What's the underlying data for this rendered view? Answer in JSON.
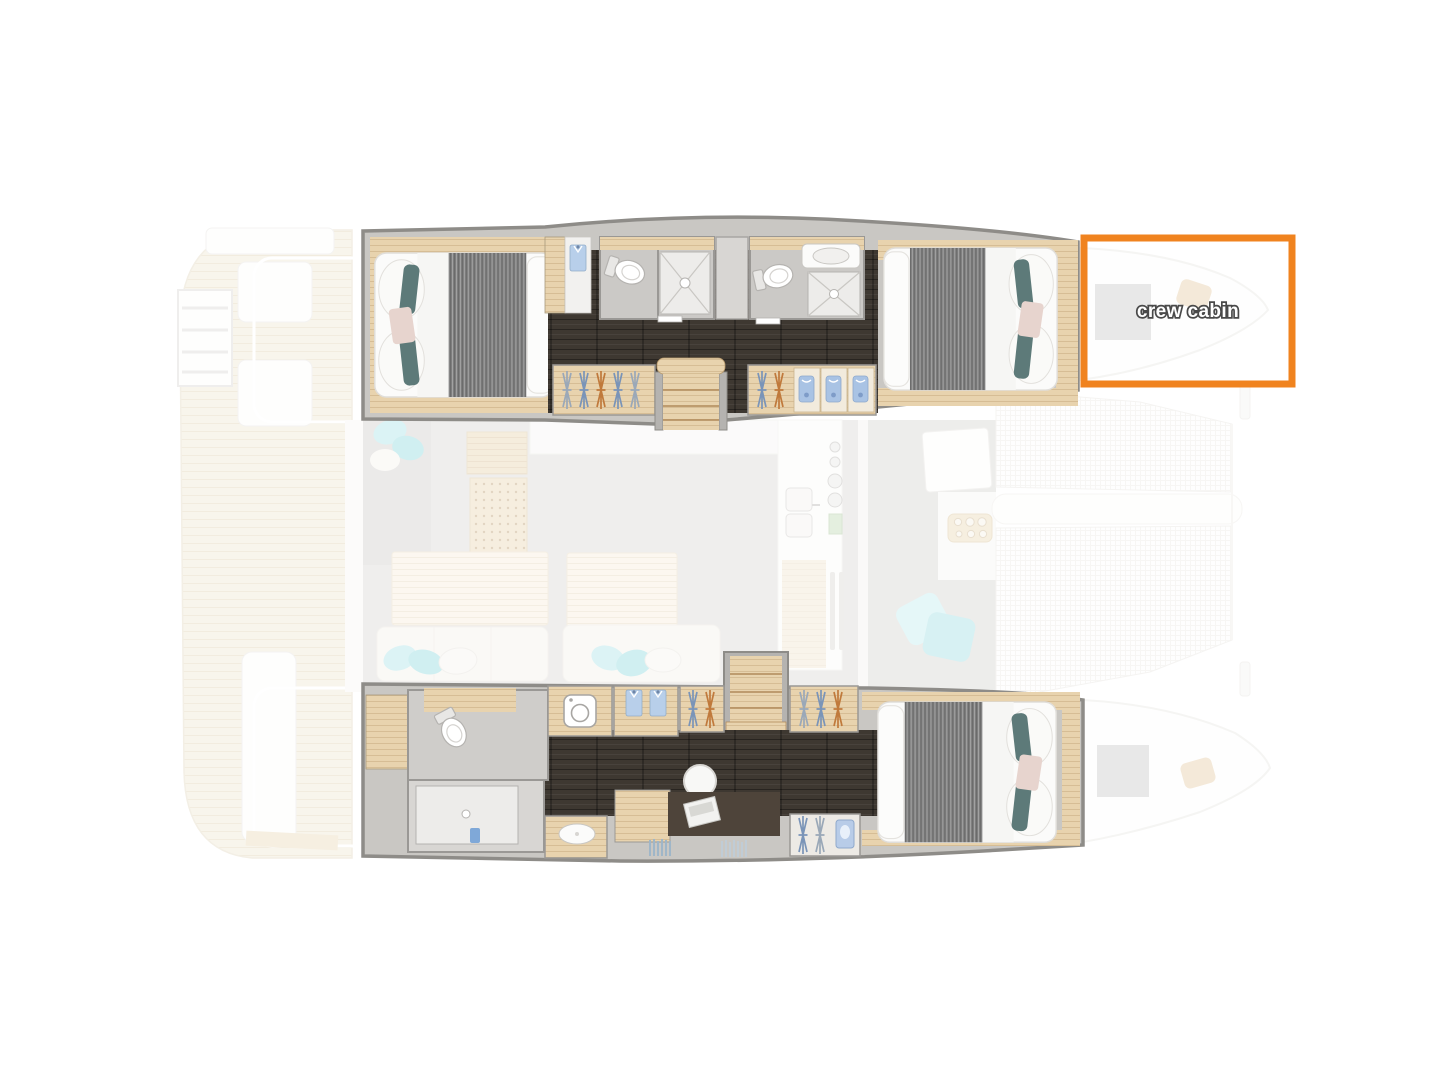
{
  "figure": {
    "kind": "catamaran-interior-floor-plan",
    "annotation": {
      "label": "crew cabin",
      "box_color": "#F0831F",
      "label_color": "#FFFFFF"
    },
    "palette": {
      "accent_orange": "#F0831F",
      "hull_wall_stroke": "#8E8C88",
      "hull_wall_fill": "#C9C7C3",
      "dark_floor": "#3E3831",
      "wood": "#E8D3AE",
      "deck_plank": "#EFE6D2",
      "bath_floor": "#CBC9C6",
      "salon_floor": "#D9D7D4",
      "duvet_gray": "#7E7E7E",
      "pillow_teal": "#5D7A79",
      "pillow_aqua": "#ABE3E6",
      "pillow_blush": "#E7D4CE",
      "towel_blue": "#A9C3E4",
      "hanger_blue": "#7A94B8",
      "hanger_orange": "#C07A3C"
    }
  }
}
